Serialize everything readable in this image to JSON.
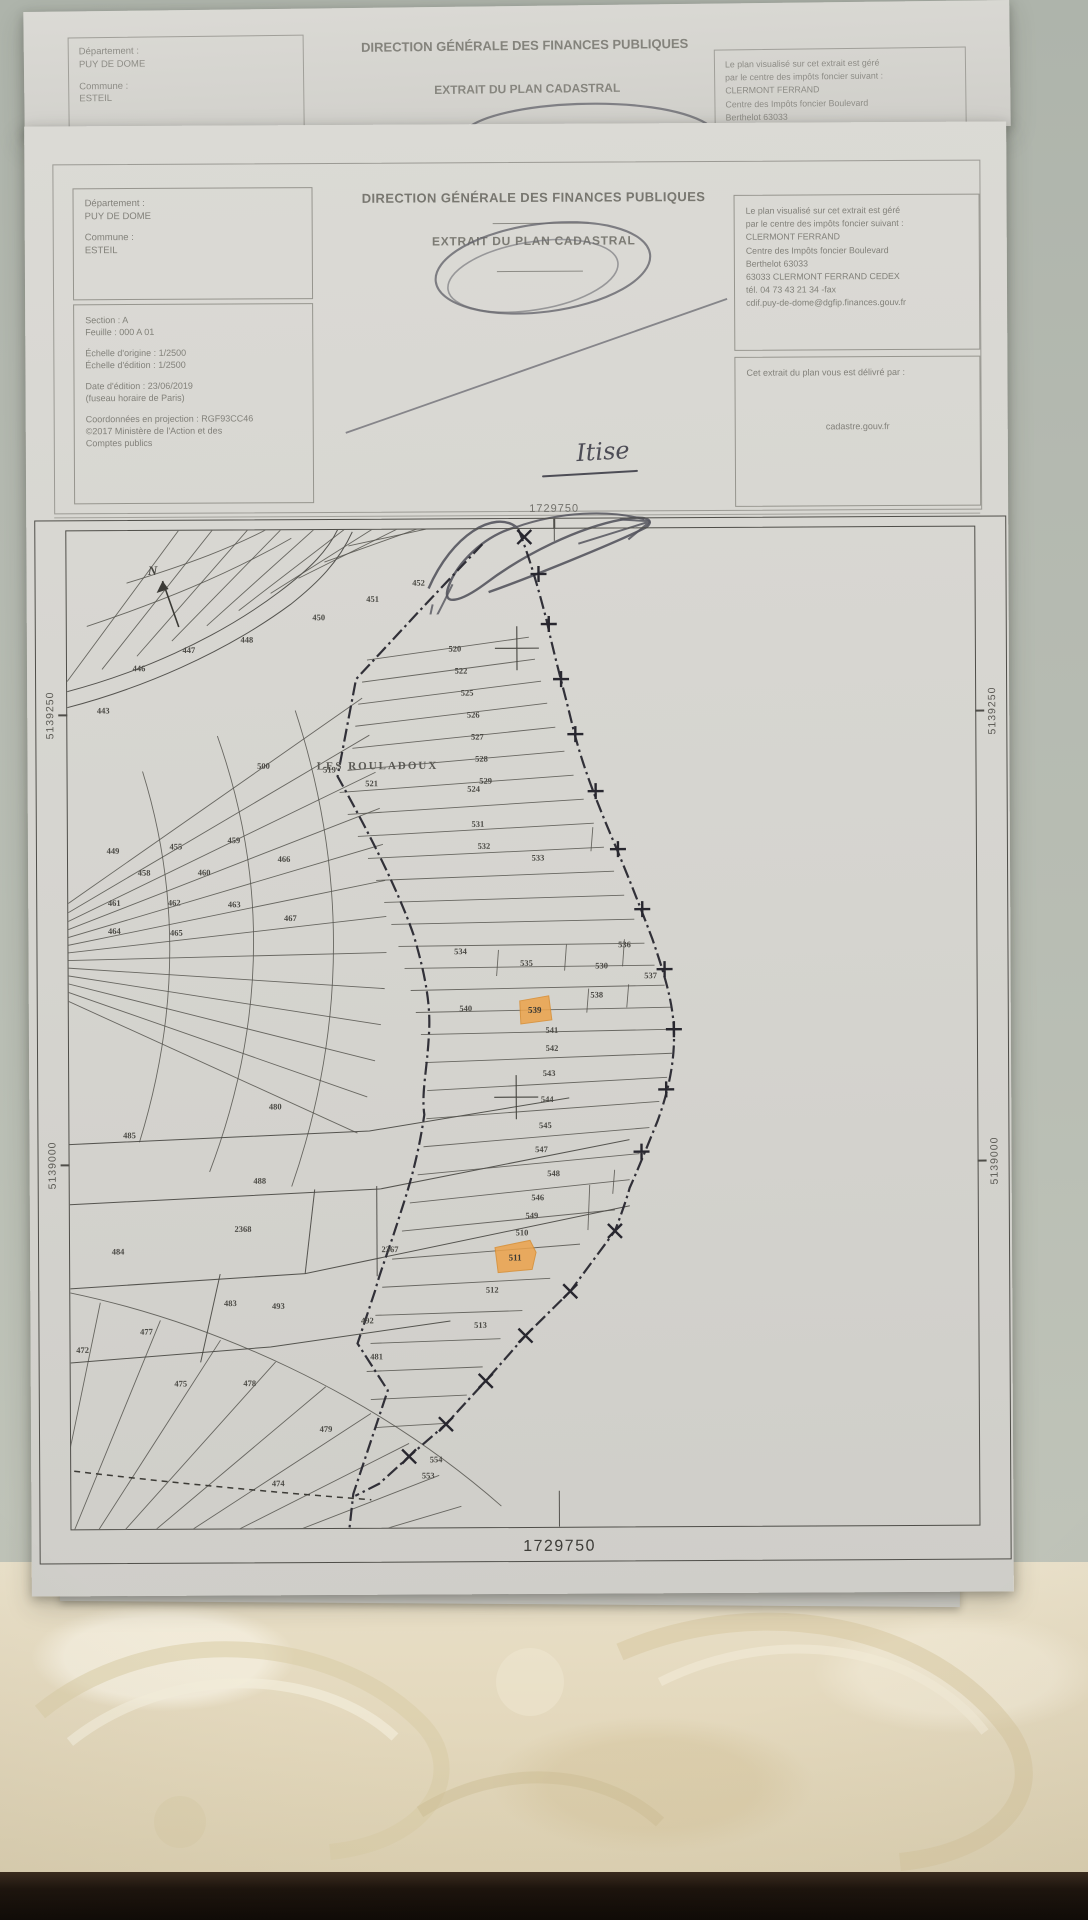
{
  "photo": {
    "surface_color": "#b4b9b0",
    "fabric_color": "#e6dcc2",
    "dark_strip_color": "#150e08",
    "paper_color": "#d6d5d0"
  },
  "sheet_behind": {
    "dept_label": "Département :",
    "dept_value": "PUY DE DOME",
    "commune_label": "Commune :",
    "commune_value": "ESTEIL",
    "title": "DIRECTION GÉNÉRALE DES FINANCES PUBLIQUES",
    "subtitle": "EXTRAIT DU PLAN CADASTRAL",
    "right_lines": [
      "Le plan visualisé sur cet extrait est géré",
      "par le centre des impôts foncier suivant :",
      "CLERMONT FERRAND",
      "Centre des Impôts foncier Boulevard",
      "Berthelot 63033"
    ]
  },
  "header": {
    "title": "DIRECTION GÉNÉRALE DES FINANCES PUBLIQUES",
    "subtitle": "EXTRAIT DU PLAN CADASTRAL",
    "dept_label": "Département :",
    "dept_value": "PUY DE DOME",
    "commune_label": "Commune :",
    "commune_value": "ESTEIL",
    "section_line": "Section : A",
    "sheet_line": "Feuille : 000 A 01",
    "scale_origin": "Échelle d'origine : 1/2500",
    "scale_edition": "Échelle d'édition : 1/2500",
    "edition_date": "Date d'édition : 23/06/2019",
    "timezone_note": "(fuseau horaire de Paris)",
    "projection": "Coordonnées en projection : RGF93CC46",
    "copyright_line1": "©2017 Ministère de l'Action et des",
    "copyright_line2": "Comptes publics",
    "managed_by_lines": [
      "Le plan visualisé sur cet extrait est géré",
      "par le centre des impôts foncier suivant :",
      "CLERMONT FERRAND",
      "Centre des Impôts foncier Boulevard",
      "Berthelot 63033",
      "63033 CLERMONT FERRAND CEDEX",
      "tél. 04 73 43 21 34 -fax",
      "cdif.puy-de-dome@dgfip.finances.gouv.fr"
    ],
    "issued_label": "Cet extrait du plan vous est délivré par :",
    "issued_value": "cadastre.gouv.fr",
    "handwriting": "Itise"
  },
  "map": {
    "top_coordinate": "1729750",
    "bottom_coordinate": "1729750",
    "left_coordinates": [
      "5139250",
      "5139000"
    ],
    "right_coordinates": [
      "5139250",
      "5139000"
    ],
    "place_name": "LES ROULADOUX",
    "north_label": "N",
    "highlight_color": "#eca34b",
    "highlighted_parcels": [
      "539",
      "511"
    ],
    "parcels": [
      {
        "n": "443",
        "x": 36,
        "y": 182
      },
      {
        "n": "446",
        "x": 72,
        "y": 140
      },
      {
        "n": "447",
        "x": 122,
        "y": 122
      },
      {
        "n": "448",
        "x": 180,
        "y": 112
      },
      {
        "n": "450",
        "x": 252,
        "y": 90
      },
      {
        "n": "451",
        "x": 306,
        "y": 72
      },
      {
        "n": "452",
        "x": 352,
        "y": 56
      },
      {
        "n": "500",
        "x": 196,
        "y": 238
      },
      {
        "n": "519",
        "x": 262,
        "y": 242
      },
      {
        "n": "521",
        "x": 304,
        "y": 256
      },
      {
        "n": "524",
        "x": 406,
        "y": 262
      },
      {
        "n": "520",
        "x": 388,
        "y": 122
      },
      {
        "n": "522",
        "x": 394,
        "y": 144
      },
      {
        "n": "525",
        "x": 400,
        "y": 166
      },
      {
        "n": "526",
        "x": 406,
        "y": 188
      },
      {
        "n": "527",
        "x": 410,
        "y": 210
      },
      {
        "n": "528",
        "x": 414,
        "y": 232
      },
      {
        "n": "529",
        "x": 418,
        "y": 254
      },
      {
        "n": "531",
        "x": 410,
        "y": 297
      },
      {
        "n": "532",
        "x": 416,
        "y": 319
      },
      {
        "n": "533",
        "x": 470,
        "y": 331
      },
      {
        "n": "536",
        "x": 556,
        "y": 418
      },
      {
        "n": "534",
        "x": 392,
        "y": 424
      },
      {
        "n": "535",
        "x": 458,
        "y": 436
      },
      {
        "n": "530",
        "x": 533,
        "y": 439
      },
      {
        "n": "537",
        "x": 582,
        "y": 449
      },
      {
        "n": "538",
        "x": 528,
        "y": 468
      },
      {
        "n": "540",
        "x": 397,
        "y": 481
      },
      {
        "n": "539",
        "x": 466,
        "y": 483,
        "hl": true
      },
      {
        "n": "541",
        "x": 483,
        "y": 503
      },
      {
        "n": "542",
        "x": 483,
        "y": 521
      },
      {
        "n": "543",
        "x": 480,
        "y": 546
      },
      {
        "n": "544",
        "x": 478,
        "y": 572
      },
      {
        "n": "545",
        "x": 476,
        "y": 598
      },
      {
        "n": "547",
        "x": 472,
        "y": 622
      },
      {
        "n": "548",
        "x": 484,
        "y": 646
      },
      {
        "n": "546",
        "x": 468,
        "y": 670
      },
      {
        "n": "549",
        "x": 462,
        "y": 688
      },
      {
        "n": "510",
        "x": 452,
        "y": 705
      },
      {
        "n": "511",
        "x": 445,
        "y": 730,
        "hl": true
      },
      {
        "n": "512",
        "x": 422,
        "y": 762
      },
      {
        "n": "513",
        "x": 410,
        "y": 797
      },
      {
        "n": "554",
        "x": 365,
        "y": 931
      },
      {
        "n": "553",
        "x": 357,
        "y": 947
      },
      {
        "n": "449",
        "x": 45,
        "y": 322
      },
      {
        "n": "455",
        "x": 108,
        "y": 318
      },
      {
        "n": "459",
        "x": 166,
        "y": 312
      },
      {
        "n": "458",
        "x": 76,
        "y": 344
      },
      {
        "n": "460",
        "x": 136,
        "y": 344
      },
      {
        "n": "466",
        "x": 216,
        "y": 331
      },
      {
        "n": "461",
        "x": 46,
        "y": 374
      },
      {
        "n": "462",
        "x": 106,
        "y": 374
      },
      {
        "n": "463",
        "x": 166,
        "y": 376
      },
      {
        "n": "464",
        "x": 46,
        "y": 402
      },
      {
        "n": "465",
        "x": 108,
        "y": 404
      },
      {
        "n": "467",
        "x": 222,
        "y": 390
      },
      {
        "n": "480",
        "x": 206,
        "y": 578
      },
      {
        "n": "485",
        "x": 60,
        "y": 606
      },
      {
        "n": "488",
        "x": 190,
        "y": 652
      },
      {
        "n": "2368",
        "x": 173,
        "y": 700
      },
      {
        "n": "484",
        "x": 48,
        "y": 722
      },
      {
        "n": "2367",
        "x": 320,
        "y": 721
      },
      {
        "n": "493",
        "x": 208,
        "y": 777
      },
      {
        "n": "483",
        "x": 160,
        "y": 774
      },
      {
        "n": "492",
        "x": 297,
        "y": 792
      },
      {
        "n": "472",
        "x": 12,
        "y": 820
      },
      {
        "n": "477",
        "x": 76,
        "y": 802
      },
      {
        "n": "475",
        "x": 110,
        "y": 854
      },
      {
        "n": "478",
        "x": 179,
        "y": 854
      },
      {
        "n": "481",
        "x": 306,
        "y": 828
      },
      {
        "n": "479",
        "x": 255,
        "y": 900
      },
      {
        "n": "474",
        "x": 207,
        "y": 954
      }
    ]
  }
}
